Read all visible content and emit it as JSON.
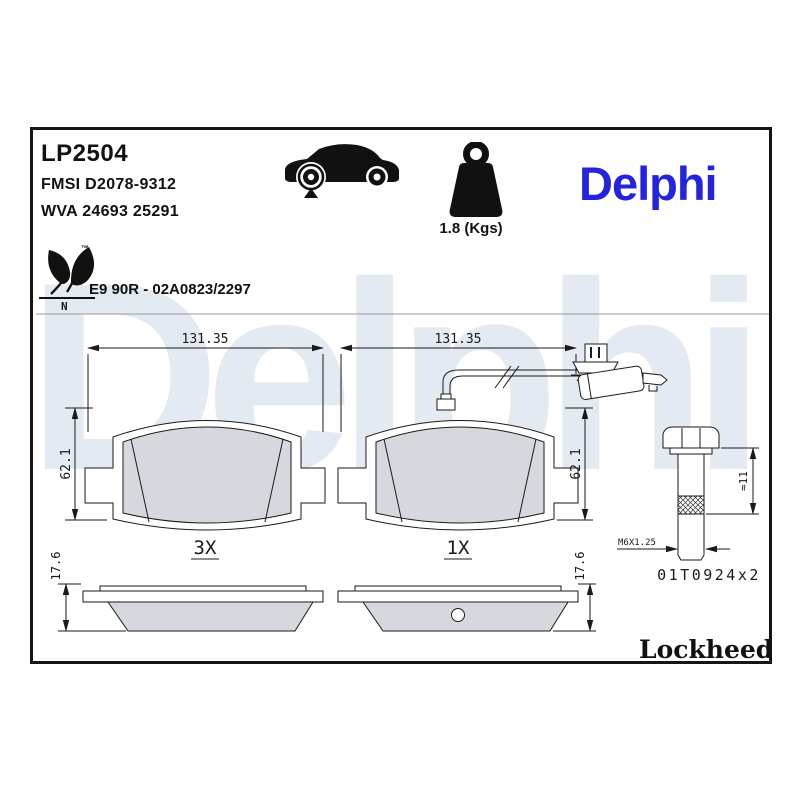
{
  "header": {
    "part_number": "LP2504",
    "fmsi_ref": "FMSI D2078-9312",
    "wva_ref": "WVA 24693 25291",
    "approval": "E9 90R - 02A0823/2297",
    "weight": "1.8 (Kgs)",
    "eco_mark": "N",
    "trademark": "™"
  },
  "brand": {
    "logo": "Delphi",
    "logo_color": "#2424e0",
    "watermark": "Delphi",
    "watermark_color": "#e3eaf1"
  },
  "footer": {
    "lockheed": "Lockheed",
    "registered": "®"
  },
  "drawing": {
    "pad_front_plain": {
      "width": "131.35",
      "height": "62.1",
      "qty": "3X"
    },
    "pad_front_sensor": {
      "width": "131.35",
      "height": "62.1",
      "qty": "1X"
    },
    "pad_side_plain": {
      "thickness": "17.6"
    },
    "pad_side_sensor": {
      "thickness": "17.6"
    },
    "bolt": {
      "length": "≈11",
      "thread": "M6X1.25",
      "ref": "01T0924x2"
    }
  }
}
